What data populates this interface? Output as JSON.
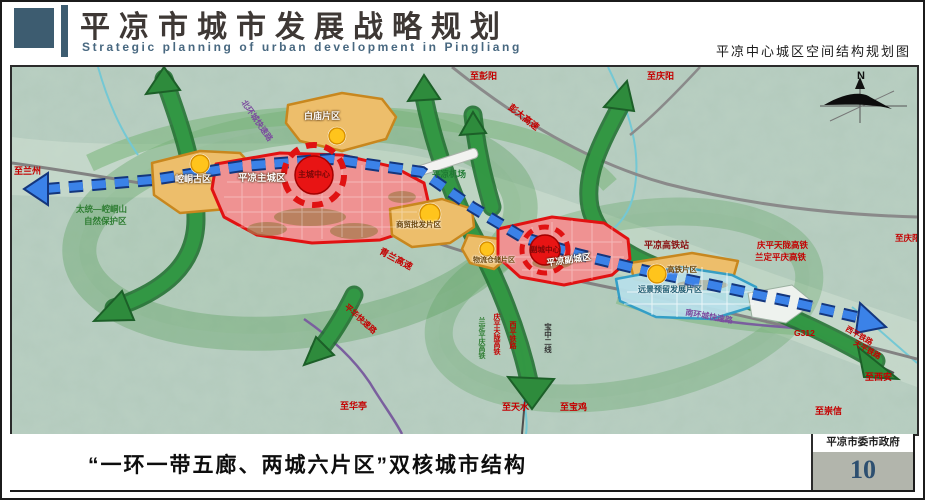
{
  "header": {
    "title": "平凉市城市发展战略规划",
    "subtitle": "Strategic planning of urban development in Pingliang",
    "map_caption": "平凉中心城区空间结构规划图"
  },
  "footer": {
    "slogan": "“一环一带五廊、两城六片区”双核城市结构",
    "authority": "平凉市委市政府",
    "page_number": "10"
  },
  "colors": {
    "header_accent": "#3d5c70",
    "title_color": "#3e3835",
    "subtitle_color": "#486880",
    "map_background": "#b9cfc2",
    "zone_orange": "#edbe6b",
    "zone_orange_border": "#c8871e",
    "zone_red": "#ef9292",
    "zone_red_border": "#e11212",
    "zone_blue": "#b8e0ea",
    "zone_blue_border": "#2e9dc8",
    "corridor_green": "#339944",
    "axis_blue": "#3b82e8",
    "page_number_bg": "#b2b5ac",
    "page_number_color": "#2d4f70"
  },
  "map": {
    "labels": [
      {
        "text": "N",
        "x": 845,
        "y": 4,
        "color": "#111111",
        "size": 11
      },
      {
        "text": "至兰州",
        "x": 2,
        "y": 100,
        "color": "#c40000",
        "size": 9
      },
      {
        "text": "至彭阳",
        "x": 458,
        "y": 5,
        "color": "#c40000",
        "size": 9
      },
      {
        "text": "至庆阳",
        "x": 635,
        "y": 5,
        "color": "#c40000",
        "size": 9
      },
      {
        "text": "至庆阳",
        "x": 883,
        "y": 167,
        "color": "#c40000",
        "size": 8.5
      },
      {
        "text": "彭大高速",
        "x": 500,
        "y": 36,
        "color": "#c40000",
        "size": 9,
        "rot": 38
      },
      {
        "text": "青兰高速",
        "x": 370,
        "y": 180,
        "color": "#c40000",
        "size": 9,
        "rot": 28
      },
      {
        "text": "庆平天陇高铁",
        "x": 745,
        "y": 174,
        "color": "#c40000",
        "size": 8.5
      },
      {
        "text": "兰定平庆高铁",
        "x": 743,
        "y": 186,
        "color": "#c40000",
        "size": 8.5
      },
      {
        "text": "平凉高铁站",
        "x": 632,
        "y": 174,
        "color": "#8a1212",
        "size": 9
      },
      {
        "text": "G312",
        "x": 782,
        "y": 262,
        "color": "#c40000",
        "size": 8.5
      },
      {
        "text": "西平铁路",
        "x": 836,
        "y": 258,
        "color": "#c40000",
        "size": 7.5,
        "rot": 30
      },
      {
        "text": "天平铁路",
        "x": 844,
        "y": 272,
        "color": "#c40000",
        "size": 7.5,
        "rot": 30
      },
      {
        "text": "至西安",
        "x": 853,
        "y": 306,
        "color": "#c40000",
        "size": 9
      },
      {
        "text": "至崇信",
        "x": 803,
        "y": 340,
        "color": "#c40000",
        "size": 9
      },
      {
        "text": "至华亭",
        "x": 328,
        "y": 335,
        "color": "#c40000",
        "size": 9
      },
      {
        "text": "至天水",
        "x": 490,
        "y": 336,
        "color": "#c40000",
        "size": 9
      },
      {
        "text": "至宝鸡",
        "x": 548,
        "y": 336,
        "color": "#c40000",
        "size": 9
      },
      {
        "text": "宝中二线",
        "x": 532,
        "y": 256,
        "color": "#333333",
        "size": 7.5,
        "vertical": true
      },
      {
        "text": "兰定平庆高铁",
        "x": 466,
        "y": 250,
        "color": "#2e7d32",
        "size": 7,
        "vertical": true
      },
      {
        "text": "庆平天陇高铁",
        "x": 481,
        "y": 246,
        "color": "#c40000",
        "size": 7,
        "vertical": true
      },
      {
        "text": "西平铁路",
        "x": 497,
        "y": 254,
        "color": "#c40000",
        "size": 7,
        "vertical": true
      },
      {
        "text": "北环城快速路",
        "x": 234,
        "y": 32,
        "color": "#7b4a9e",
        "size": 8,
        "rot": 55
      },
      {
        "text": "南环城快速路",
        "x": 674,
        "y": 242,
        "color": "#7b4a9e",
        "size": 8,
        "rot": 10
      },
      {
        "text": "平华快速路",
        "x": 336,
        "y": 236,
        "color": "#c40000",
        "size": 8,
        "rot": 42
      },
      {
        "text": "平凉机场",
        "x": 420,
        "y": 103,
        "color": "#1e7a32",
        "size": 8.5
      },
      {
        "text": "太统—崆峒山",
        "x": 64,
        "y": 138,
        "color": "#2e7d32",
        "size": 8.5
      },
      {
        "text": "自然保护区",
        "x": 72,
        "y": 150,
        "color": "#2e7d32",
        "size": 8.5
      },
      {
        "text": "崆峒古区",
        "x": 163,
        "y": 108,
        "color": "#ffffff",
        "size": 9,
        "halo": "dark"
      },
      {
        "text": "白庙片区",
        "x": 292,
        "y": 45,
        "color": "#ffffff",
        "size": 9,
        "halo": "dark"
      },
      {
        "text": "平凉主城区",
        "x": 226,
        "y": 107,
        "color": "#ffffff",
        "size": 9.5,
        "halo": "dark"
      },
      {
        "text": "主城中心",
        "x": 286,
        "y": 104,
        "color": "#7a0808",
        "size": 8
      },
      {
        "text": "商贸批发片区",
        "x": 384,
        "y": 154,
        "color": "#6b4509",
        "size": 7.5,
        "halo": "light"
      },
      {
        "text": "物流仓储片区",
        "x": 461,
        "y": 190,
        "color": "#6b4509",
        "size": 7,
        "halo": "light"
      },
      {
        "text": "平凉副城区",
        "x": 534,
        "y": 192,
        "color": "#ffffff",
        "size": 9,
        "rot": -8,
        "halo": "dark"
      },
      {
        "text": "副城中心",
        "x": 518,
        "y": 179,
        "color": "#7a0808",
        "size": 7.5
      },
      {
        "text": "高铁片区",
        "x": 655,
        "y": 199,
        "color": "#6b4509",
        "size": 7.5,
        "halo": "light"
      },
      {
        "text": "远景预留发展片区",
        "x": 626,
        "y": 219,
        "color": "#1d5a70",
        "size": 8,
        "halo": "light"
      }
    ]
  }
}
